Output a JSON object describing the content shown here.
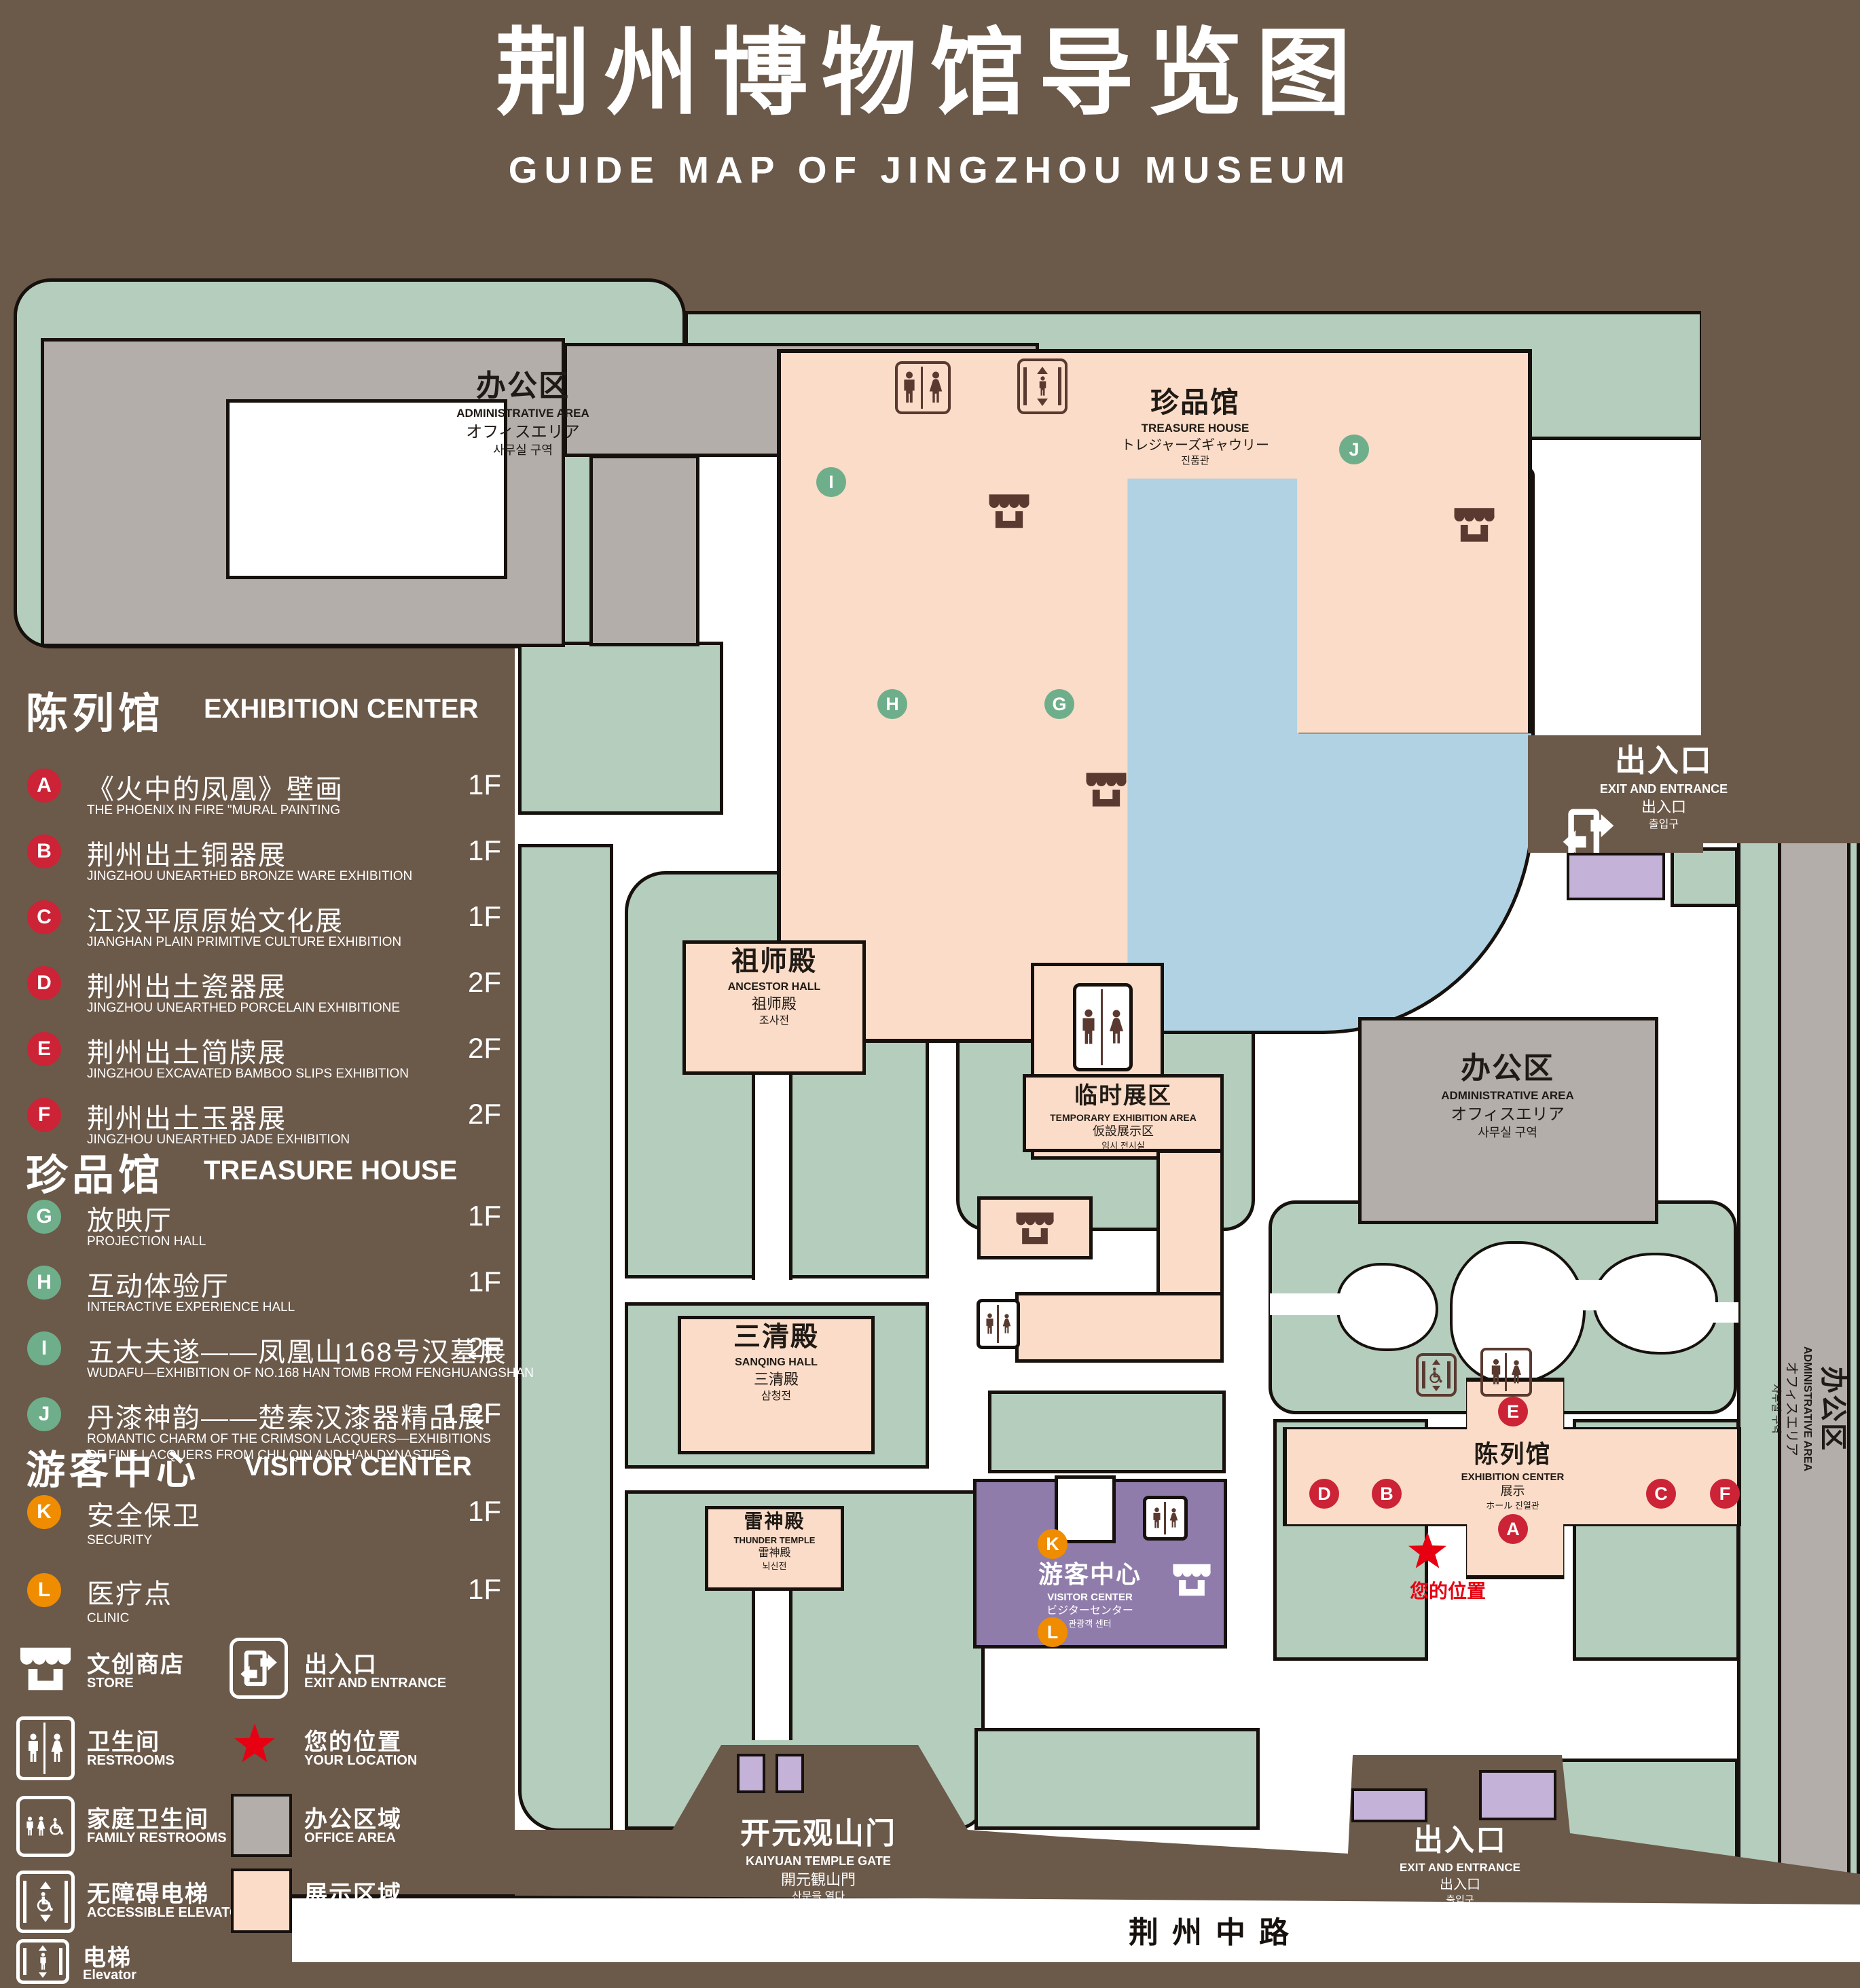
{
  "title": {
    "zh": "荆州博物馆导览图",
    "en": "GUIDE MAP OF JINGZHOU MUSEUM"
  },
  "colors": {
    "background": "#6b594a",
    "grass_green": "#b5cdbd",
    "display_pink": "#fadcc8",
    "office_gray": "#b3aeaa",
    "water_blue": "#b0d2e2",
    "visitor_purple": "#8f7cab",
    "booth_purple": "#c5b2d8",
    "badge_red": "#cc2336",
    "badge_green": "#6fae8a",
    "badge_orange": "#f08c00",
    "star_red": "#e60012",
    "icon_brown": "#5a3a30"
  },
  "sidebar": {
    "sections": [
      {
        "zh": "陈列馆",
        "en": "EXHIBITION CENTER",
        "items": [
          {
            "id": "A",
            "zh": "《火中的凤凰》壁画",
            "en": "THE PHOENIX IN FIRE \"MURAL PAINTING",
            "floor": "1F"
          },
          {
            "id": "B",
            "zh": "荆州出土铜器展",
            "en": "JINGZHOU UNEARTHED BRONZE WARE EXHIBITION",
            "floor": "1F"
          },
          {
            "id": "C",
            "zh": "江汉平原原始文化展",
            "en": "JIANGHAN PLAIN PRIMITIVE CULTURE EXHIBITION",
            "floor": "1F"
          },
          {
            "id": "D",
            "zh": "荆州出土瓷器展",
            "en": "JINGZHOU UNEARTHED PORCELAIN EXHIBITIONE",
            "floor": "2F"
          },
          {
            "id": "E",
            "zh": "荆州出土简牍展",
            "en": "JINGZHOU EXCAVATED BAMBOO SLIPS EXHIBITION",
            "floor": "2F"
          },
          {
            "id": "F",
            "zh": "荆州出土玉器展",
            "en": "JINGZHOU UNEARTHED JADE EXHIBITION",
            "floor": "2F"
          }
        ]
      },
      {
        "zh": "珍品馆",
        "en": "TREASURE HOUSE",
        "items": [
          {
            "id": "G",
            "zh": "放映厅",
            "en": "PROJECTION HALL",
            "floor": "1F"
          },
          {
            "id": "H",
            "zh": "互动体验厅",
            "en": "INTERACTIVE EXPERIENCE HALL",
            "floor": "1F"
          },
          {
            "id": "I",
            "zh": "五大夫遂——凤凰山168号汉墓展",
            "en": "WUDAFU—EXHIBITION OF NO.168 HAN TOMB FROM FENGHUANGSHAN",
            "floor": "2F"
          },
          {
            "id": "J",
            "zh": "丹漆神韵——楚秦汉漆器精品展",
            "en": "ROMANTIC CHARM OF THE CRIMSON LACQUERS—EXHIBITIONS",
            "en2": "OF FINE LACQUERS FROM CHU,QIN AND HAN DYNASTIES",
            "floor": "1-2F"
          }
        ]
      },
      {
        "zh": "游客中心",
        "en": "VISITOR CENTER",
        "items": [
          {
            "id": "K",
            "zh": "安全保卫",
            "en": "SECURITY",
            "floor": "1F"
          },
          {
            "id": "L",
            "zh": "医疗点",
            "en": "CLINIC",
            "floor": "1F"
          }
        ]
      }
    ],
    "legend": [
      {
        "icon": "store-icon",
        "zh": "文创商店",
        "en": "STORE"
      },
      {
        "icon": "exit-icon",
        "zh": "出入口",
        "en": "EXIT AND ENTRANCE"
      },
      {
        "icon": "restrooms-icon",
        "zh": "卫生间",
        "en": "RESTROOMS"
      },
      {
        "icon": "location-star-icon",
        "zh": "您的位置",
        "en": "YOUR LOCATION"
      },
      {
        "icon": "family-restrooms-icon",
        "zh": "家庭卫生间",
        "en": "FAMILY RESTROOMS"
      },
      {
        "icon": "office-area-swatch",
        "zh": "办公区域",
        "en": "OFFICE AREA"
      },
      {
        "icon": "accessible-elevator-icon",
        "zh": "无障碍电梯",
        "en": "ACCESSIBLE ELEVATOR"
      },
      {
        "icon": "display-area-swatch",
        "zh": "展示区域",
        "en": "DISPLAY AREA"
      },
      {
        "icon": "elevator-icon",
        "zh": "电梯",
        "en": "Elevator"
      }
    ]
  },
  "map": {
    "admin": {
      "lines": [
        "办公区",
        "ADMINISTRATIVE AREA",
        "オフィスエリア",
        "사무실 구역"
      ]
    },
    "treasure": {
      "lines": [
        "珍品馆",
        "TREASURE HOUSE",
        "トレジャーズギャウリー",
        "진품관"
      ]
    },
    "ancestor": {
      "lines": [
        "祖师殿",
        "ANCESTOR HALL",
        "祖师殿",
        "조사전"
      ]
    },
    "sanqing": {
      "lines": [
        "三清殿",
        "SANQING HALL",
        "三清殿",
        "삼청전"
      ]
    },
    "thunder": {
      "lines": [
        "雷神殿",
        "THUNDER TEMPLE",
        "雷神殿",
        "뇌신전"
      ]
    },
    "temporary": {
      "lines": [
        "临时展区",
        "TEMPORARY EXHIBITION AREA",
        "仮設展示区",
        "임시 전시실"
      ]
    },
    "exhibition": {
      "lines": [
        "陈列馆",
        "EXHIBITION CENTER",
        "展示",
        "ホール 진열관"
      ]
    },
    "visitor": {
      "lines": [
        "游客中心",
        "VISITOR CENTER",
        "ビジターセンター",
        "관광객 센터"
      ]
    },
    "gate": {
      "lines": [
        "开元观山门",
        "KAIYUAN TEMPLE GATE",
        "開元観山門",
        "산문을 열다"
      ]
    },
    "exit": {
      "lines": [
        "出入口",
        "EXIT AND ENTRANCE",
        "出入口",
        "출입구"
      ]
    },
    "road": "荆州中路",
    "your_location": "您的位置",
    "markers": {
      "A": "A",
      "B": "B",
      "C": "C",
      "D": "D",
      "E": "E",
      "F": "F",
      "G": "G",
      "H": "H",
      "I": "I",
      "J": "J",
      "K": "K",
      "L": "L"
    }
  }
}
